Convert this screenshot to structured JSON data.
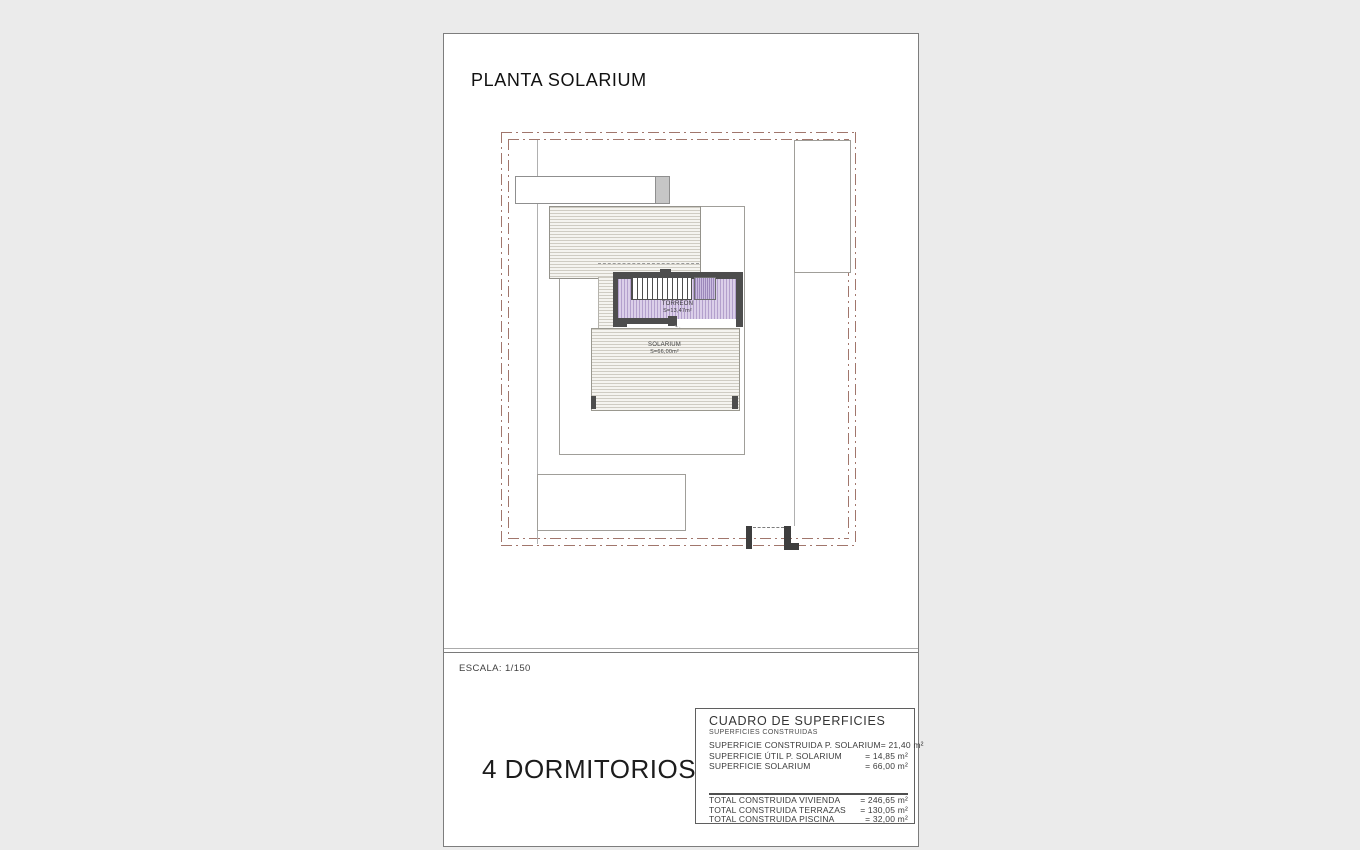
{
  "sheet": {
    "title": "PLANTA SOLARIUM",
    "scale": "ESCALA: 1/150",
    "bedrooms": "4 DORMITORIOS"
  },
  "plan": {
    "torreon": {
      "name": "TORREÓN",
      "area": "S=13,47m²"
    },
    "solarium": {
      "name": "SOLARIUM",
      "area": "S=66,00m²"
    },
    "colors": {
      "boundary": "#a1766c",
      "wall": "#4d4d4d",
      "torreon_fill": "#dbcfe9",
      "hatch_line": "#cfccc3",
      "outline": "#a09e99"
    }
  },
  "table": {
    "title": "CUADRO DE SUPERFICIES",
    "subtitle": "SUPERFICIES CONSTRUIDAS",
    "rows": [
      {
        "label": "SUPERFICIE CONSTRUIDA P. SOLARIUM",
        "value": "= 21,40 m²"
      },
      {
        "label": "SUPERFICIE ÚTIL P. SOLARIUM",
        "value": "= 14,85 m²"
      },
      {
        "label": "SUPERFICIE SOLARIUM",
        "value": "= 66,00 m²"
      }
    ],
    "totals": [
      {
        "label": "TOTAL CONSTRUIDA VIVIENDA",
        "value": "= 246,65 m²"
      },
      {
        "label": "TOTAL CONSTRUIDA TERRAZAS",
        "value": "= 130,05 m²"
      },
      {
        "label": "TOTAL CONSTRUIDA PISCINA",
        "value": "= 32,00 m²"
      }
    ]
  }
}
